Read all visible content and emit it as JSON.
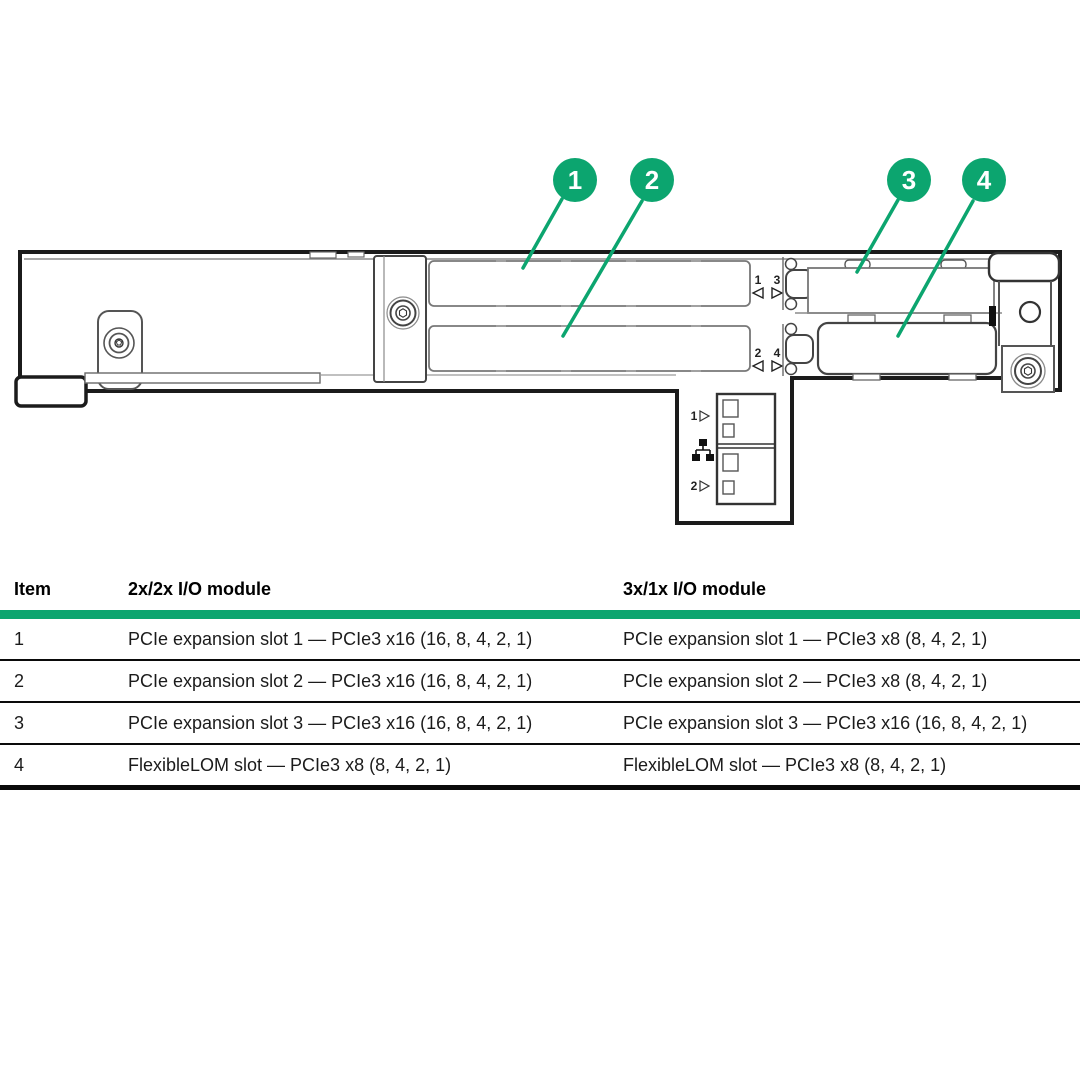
{
  "colors": {
    "accent_green": "#0CA56F",
    "line_dark": "#1b1b1b",
    "table_text": "#1b1b1b"
  },
  "diagram": {
    "callouts": [
      {
        "label": "1"
      },
      {
        "label": "2"
      },
      {
        "label": "3"
      },
      {
        "label": "4"
      }
    ],
    "slot_indicators": {
      "upper_left_num": "1",
      "upper_right_num": "3",
      "lower_left_num": "2",
      "lower_right_num": "4"
    },
    "nic_ports": {
      "port1_label": "1",
      "port2_label": "2",
      "between_icon": "network-icon"
    }
  },
  "table": {
    "headers": [
      "Item",
      "2x/2x I/O module",
      "3x/1x I/O module"
    ],
    "rows": [
      {
        "item": "1",
        "module_2x2x": "PCIe expansion slot 1 — PCIe3 x16 (16, 8, 4, 2, 1)",
        "module_3x1x": "PCIe expansion slot 1 — PCIe3 x8 (8, 4, 2, 1)"
      },
      {
        "item": "2",
        "module_2x2x": "PCIe expansion slot 2 — PCIe3 x16 (16, 8, 4, 2, 1)",
        "module_3x1x": "PCIe expansion slot 2 — PCIe3 x8 (8, 4, 2, 1)"
      },
      {
        "item": "3",
        "module_2x2x": "PCIe expansion slot 3 — PCIe3 x16 (16, 8, 4, 2, 1)",
        "module_3x1x": "PCIe expansion slot 3 — PCIe3 x16 (16, 8, 4, 2, 1)"
      },
      {
        "item": "4",
        "module_2x2x": "FlexibleLOM slot — PCIe3 x8 (8, 4, 2, 1)",
        "module_3x1x": "FlexibleLOM slot — PCIe3 x8 (8, 4, 2, 1)"
      }
    ]
  }
}
